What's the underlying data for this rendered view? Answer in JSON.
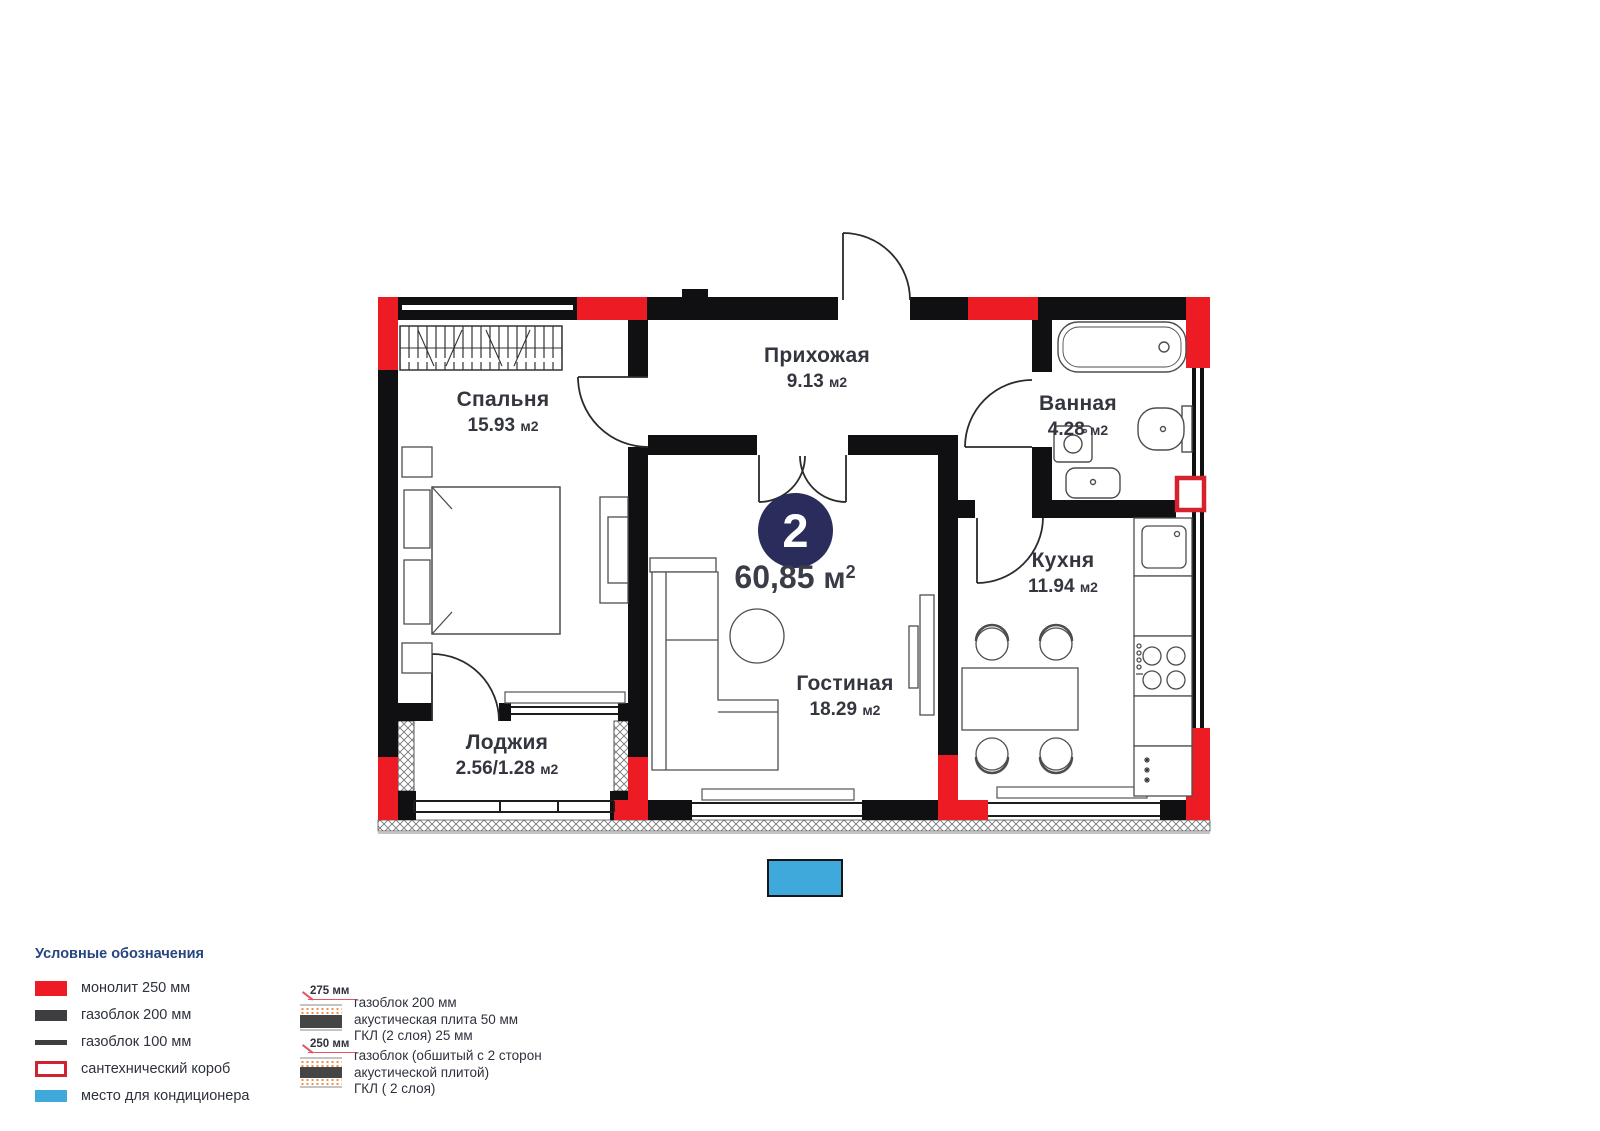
{
  "plan": {
    "type_badge": "2",
    "total_area": {
      "value": "60,85",
      "unit": "м",
      "sup": "2"
    },
    "rooms": [
      {
        "name": "Прихожая",
        "area": "9.13",
        "unit": "м2"
      },
      {
        "name": "Спальня",
        "area": "15.93",
        "unit": "м2"
      },
      {
        "name": "Ванная",
        "area": "4.28",
        "unit": "м2"
      },
      {
        "name": "Кухня",
        "area": "11.94",
        "unit": "м2"
      },
      {
        "name": "Гостиная",
        "area": "18.29",
        "unit": "м2"
      },
      {
        "name": "Лоджия",
        "area": "2.56/1.28",
        "unit": "м2"
      }
    ],
    "colors": {
      "monolith_red": "#ed1c24",
      "wall_black": "#101012",
      "badge_navy": "#2a2d5b",
      "ac_blue": "#3fa9dc",
      "label_dark": "#34363f"
    }
  },
  "legend": {
    "title": "Условные обозначения",
    "items": [
      {
        "label": "монолит 250 мм"
      },
      {
        "label": "газоблок 200 мм"
      },
      {
        "label": "газоблок 100 мм"
      },
      {
        "label": "сантехнический короб"
      },
      {
        "label": "место для кондиционера"
      }
    ],
    "wall_sections": [
      {
        "dimension": "275 мм",
        "lines": [
          "газоблок 200 мм",
          "акустическая плита 50 мм",
          "ГКЛ (2 слоя) 25 мм"
        ]
      },
      {
        "dimension": "250 мм",
        "lines": [
          "газоблок (обшитый с 2 сторон",
          "акустической плитой)",
          "ГКЛ ( 2 слоя)"
        ]
      }
    ]
  }
}
